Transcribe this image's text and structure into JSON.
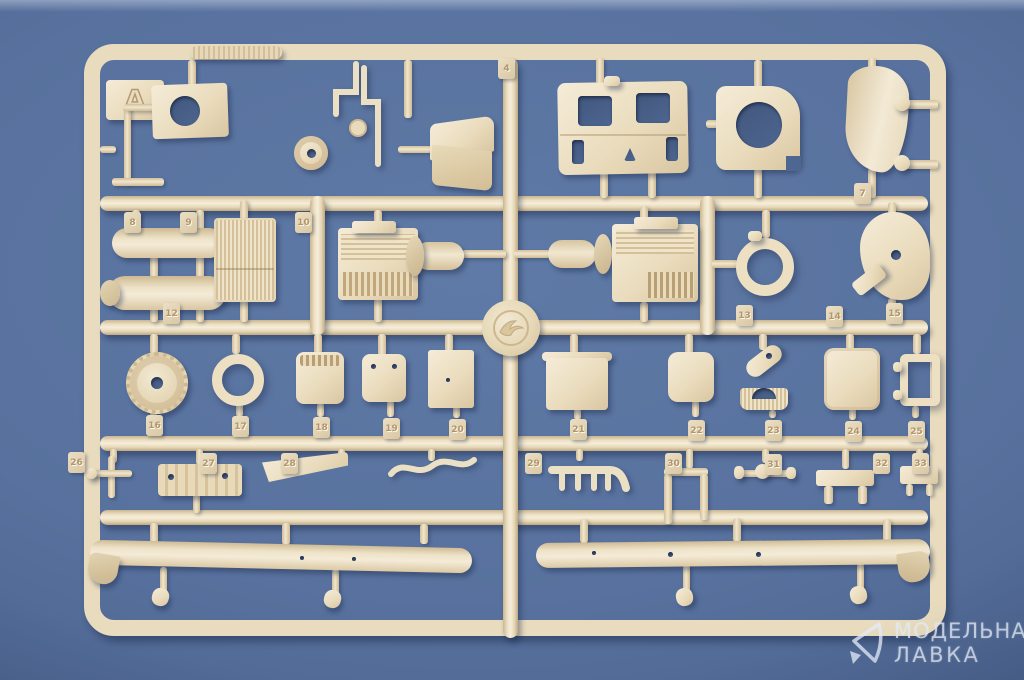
{
  "scene": {
    "subject": "tan plastic model-kit sprue, frame A, on blue background",
    "colors": {
      "plastic": "#ecdfc2",
      "background": "#56709c",
      "shadow": "#31415f"
    }
  },
  "sprue": {
    "letter": "A"
  },
  "part_tags": [
    "4",
    "7",
    "8",
    "9",
    "10",
    "12",
    "13",
    "14",
    "15",
    "16",
    "17",
    "18",
    "19",
    "20",
    "21",
    "22",
    "23",
    "24",
    "25",
    "26",
    "27",
    "28",
    "29",
    "30",
    "31",
    "32",
    "33"
  ],
  "watermark": {
    "line1": "МОДЕЛЬНАЯ",
    "line2": "ЛАВКА"
  }
}
